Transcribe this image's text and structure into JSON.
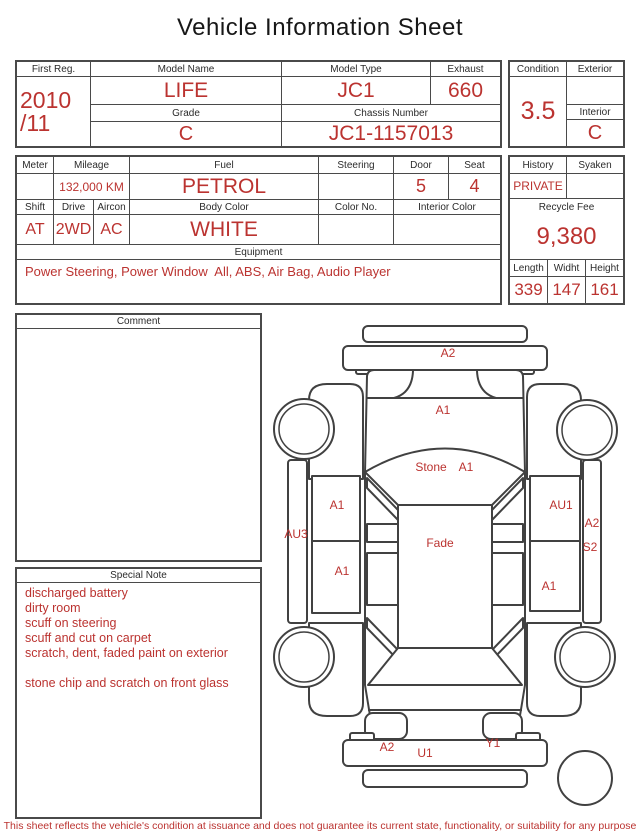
{
  "title": "Vehicle Information Sheet",
  "colors": {
    "accent_red": "#bb3330",
    "line_dark": "#4a4a4a",
    "text_dark": "#2b2b2b"
  },
  "top_table": {
    "first_reg": {
      "label": "First Reg.",
      "value_line1": "2010",
      "value_line2": "/11"
    },
    "model_name": {
      "label": "Model Name",
      "value": "LIFE"
    },
    "model_type": {
      "label": "Model Type",
      "value": "JC1"
    },
    "exhaust": {
      "label": "Exhaust",
      "value": "660"
    },
    "grade": {
      "label": "Grade",
      "value": "C"
    },
    "chassis_number": {
      "label": "Chassis Number",
      "value": "JC1-1157013"
    },
    "condition": {
      "label": "Condition",
      "value": "3.5"
    },
    "exterior": {
      "label": "Exterior",
      "value": ""
    },
    "interior": {
      "label": "Interior",
      "value": "C"
    }
  },
  "spec_table": {
    "meter": {
      "label": "Meter",
      "value": ""
    },
    "mileage": {
      "label": "Mileage",
      "value": "132,000 KM"
    },
    "fuel": {
      "label": "Fuel",
      "value": "PETROL"
    },
    "steering": {
      "label": "Steering",
      "value": ""
    },
    "door": {
      "label": "Door",
      "value": "5"
    },
    "seat": {
      "label": "Seat",
      "value": "4"
    },
    "shift": {
      "label": "Shift",
      "value": "AT"
    },
    "drive": {
      "label": "Drive",
      "value": "2WD"
    },
    "aircon": {
      "label": "Aircon",
      "value": "AC"
    },
    "body_color": {
      "label": "Body Color",
      "value": "WHITE"
    },
    "color_no": {
      "label": "Color No.",
      "value": ""
    },
    "interior_color": {
      "label": "Interior Color",
      "value": ""
    },
    "equipment": {
      "label": "Equipment",
      "value": "Power Steering, Power Window  All, ABS, Air Bag, Audio Player"
    }
  },
  "fee_table": {
    "history": {
      "label": "History",
      "value": "PRIVATE"
    },
    "syaken": {
      "label": "Syaken",
      "value": ""
    },
    "recycle_fee": {
      "label": "Recycle Fee",
      "value": "9,380"
    },
    "length": {
      "label": "Length",
      "value": "339"
    },
    "width": {
      "label": "Widht",
      "value": "147"
    },
    "height": {
      "label": "Height",
      "value": "161"
    }
  },
  "comment": {
    "label": "Comment",
    "value": ""
  },
  "special_note": {
    "label": "Special Note",
    "lines": [
      "discharged battery",
      "dirty room",
      "scuff on steering",
      "scuff and cut on carpet",
      "scratch, dent, faded paint on exterior",
      "",
      "stone chip and scratch on front glass"
    ]
  },
  "diagram": {
    "markers": [
      {
        "part": "front-bumper",
        "code": "A2",
        "x": 178,
        "y": 44
      },
      {
        "part": "hood",
        "code": "A1",
        "x": 173,
        "y": 101
      },
      {
        "part": "windshield-stone",
        "code": "Stone",
        "x": 161,
        "y": 158
      },
      {
        "part": "windshield",
        "code": "A1",
        "x": 196,
        "y": 158
      },
      {
        "part": "left-front-door",
        "code": "A1",
        "x": 67,
        "y": 196
      },
      {
        "part": "right-front-door",
        "code": "AU1",
        "x": 291,
        "y": 196
      },
      {
        "part": "left-sill",
        "code": "AU3",
        "x": 26,
        "y": 225
      },
      {
        "part": "right-sill-upper",
        "code": "A2",
        "x": 322,
        "y": 214
      },
      {
        "part": "right-sill-lower",
        "code": "S2",
        "x": 320,
        "y": 238
      },
      {
        "part": "roof",
        "code": "Fade",
        "x": 170,
        "y": 234
      },
      {
        "part": "left-rear-door",
        "code": "A1",
        "x": 72,
        "y": 262
      },
      {
        "part": "right-rear-door",
        "code": "A1",
        "x": 279,
        "y": 277
      },
      {
        "part": "rear-bumper-left",
        "code": "A2",
        "x": 117,
        "y": 438
      },
      {
        "part": "rear-bumper-center",
        "code": "U1",
        "x": 155,
        "y": 444
      },
      {
        "part": "rear-bumper-right",
        "code": "Y1",
        "x": 223,
        "y": 434
      }
    ]
  },
  "footer": {
    "disclaimer": "This sheet reflects the vehicle's condition at issuance and does not guarantee its current state, functionality, or suitability for any purpose"
  }
}
